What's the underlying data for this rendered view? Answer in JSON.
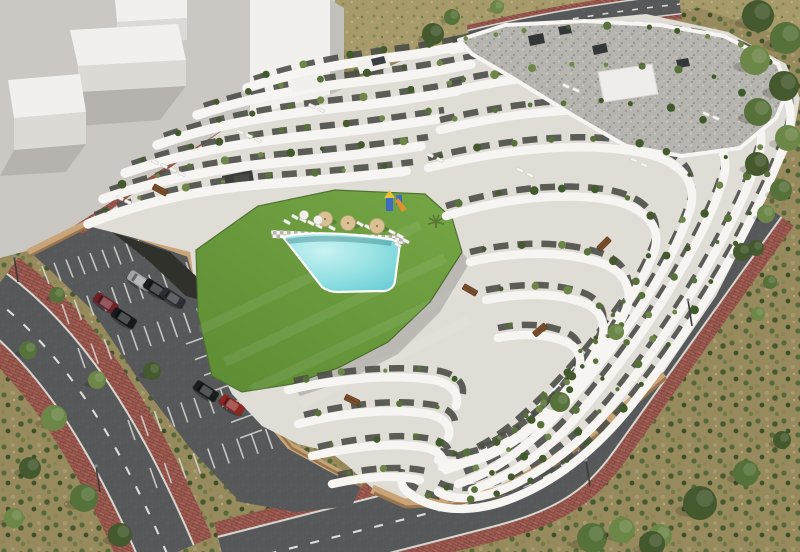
{
  "scene": {
    "type": "architectural-aerial-render",
    "subject": "modern white terraced apartment complex with courtyard swimming pool, lawn, private parking lot and perimeter streets",
    "setting": "semi-arid plot with dry scrub vegetation and neighbouring untextured massing blocks",
    "style": "3D visualization, midday sun"
  },
  "palette": {
    "plaza": "#cbc8c3",
    "block_top": "#f1f0ec",
    "block_face": "#dcdad5",
    "block_dark": "#c2c0bb",
    "field": "#a79b6c",
    "scrub": "#978b5e",
    "tree_dark": "#45592e",
    "tree_mid": "#57713a",
    "tree_light": "#6c8747",
    "asphalt": "#56585a",
    "lane": "#e9e8e4",
    "brick": "#9c5a51",
    "brick_dark": "#7d453d",
    "brick_light": "#b06a5c",
    "curb": "#d8d6d0",
    "wall_tan": "#c9a478",
    "wall_tan_dark": "#96754f",
    "lawn_a": "#74a544",
    "lawn_b": "#5d8c34",
    "pool_light": "#c8f2f2",
    "pool_mid": "#8fdfe2",
    "pool_deep": "#5fc8cf",
    "deck_light": "#f3f2ee",
    "deck_dark": "#b5b3ae",
    "bld_floor": "#e0ddd7",
    "bld_white": "#f6f5f2",
    "glazing": "#4b4e47",
    "roof_a": "#b6b4af",
    "roof_b": "#94928c",
    "parasol": "#d9c194",
    "wood": "#7a4f2d",
    "play_blue": "#3f6cc0",
    "play_yellow": "#e8c33a",
    "play_orange": "#e0902e",
    "lounger": "#f5f4f0"
  },
  "site": {
    "building": {
      "facade": "white curved cantilevered terraces with dark glazing",
      "roof": "grey gravel flat roof with white parapet",
      "rooftop_units": 4,
      "balcony_planting": true,
      "terrace_band_count": 14
    },
    "courtyard": {
      "lawn": true,
      "pool": {
        "count": 1,
        "shape": "freeform",
        "color": "turquoise"
      },
      "parasol_count": 3,
      "white_parasol_count": 2,
      "sun_lounger_count": 12,
      "picnic_table_count": 5,
      "playground": {
        "present": true,
        "colors": [
          "blue",
          "yellow",
          "orange"
        ]
      }
    },
    "parking": {
      "car_count": 9,
      "car_colors": [
        "#a0a3a6",
        "#1b1d1f",
        "#2b2e34",
        "#6e2127",
        "#17191b",
        "#49584b",
        "#121416",
        "#1a1c1e",
        "#8c2722"
      ],
      "surface": "asphalt",
      "marking_color": "white"
    },
    "streets": {
      "count": 3,
      "surface": "asphalt",
      "centerline": "dashed white",
      "sidewalk": "red brick pavers",
      "streetlamp_count": 4
    },
    "context": {
      "white_massing_blocks": 4,
      "dry_field": true,
      "tree_cluster": "right edge and top-right corner",
      "shrub_patches": "bottom-left and bottom-right corners"
    }
  }
}
